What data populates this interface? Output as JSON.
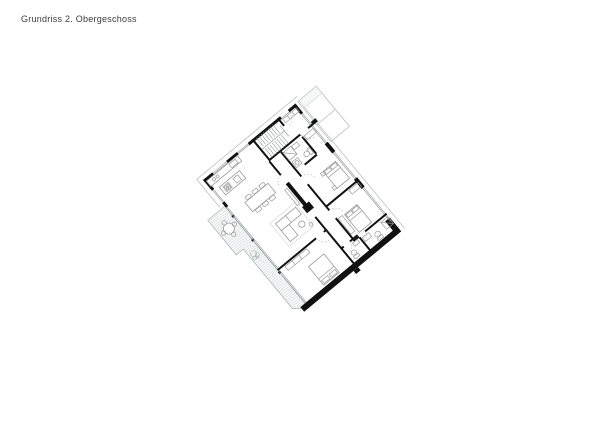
{
  "title": {
    "text": "Grundriss 2. Obergeschoss"
  },
  "drawing": {
    "type": "architectural-floor-plan",
    "floor": "2. Obergeschoss",
    "colors": {
      "background": "#ffffff",
      "walls": "#111111",
      "furniture_lines": "#9b9b9b",
      "glazing_lines": "#8c9092",
      "terrace_hatch": "#d4d7d8",
      "door_arcs": "#bcc0c1",
      "title_text": "#3b3b3b"
    },
    "elements": {
      "staircase": "double-flight stair, top of plan",
      "terrace": "hatched terrace strip with round table, 4 chairs and plant, lower-left",
      "rooms": "kitchen, dining, living with fireplace, 3 bedrooms, 2 bathrooms, wc, entry hall"
    }
  }
}
